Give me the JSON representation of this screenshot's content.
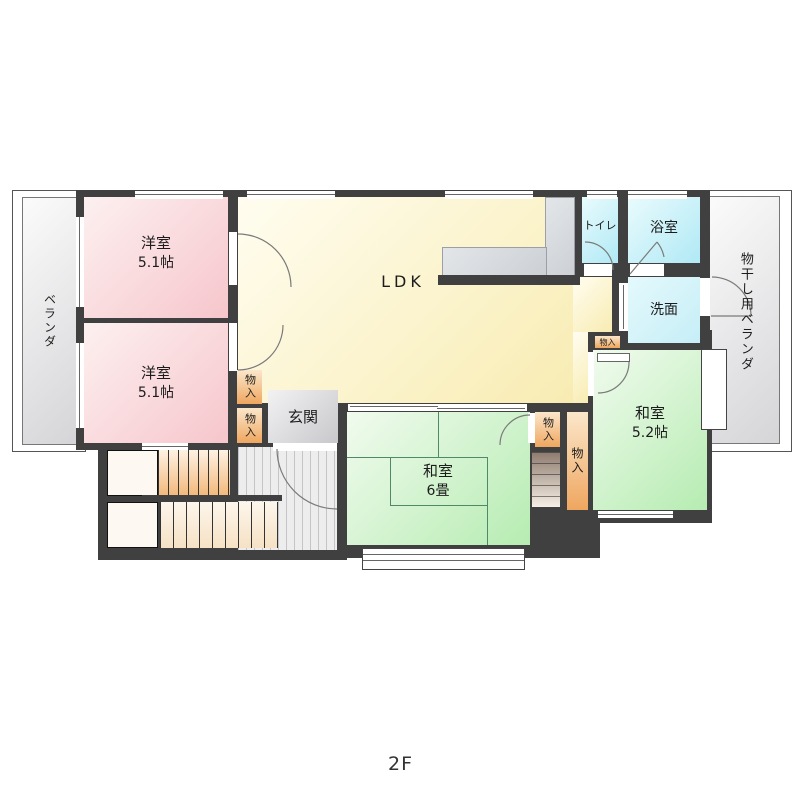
{
  "floor_label": "2F",
  "rooms": {
    "veranda_left": {
      "label": "ベランダ"
    },
    "veranda_right": {
      "label": "物干し用ベランダ"
    },
    "western_top": {
      "name": "洋室",
      "size": "5.1帖"
    },
    "western_bottom": {
      "name": "洋室",
      "size": "5.1帖"
    },
    "ldk": {
      "label": "LDK"
    },
    "toilet": {
      "label": "トイレ"
    },
    "bath": {
      "label": "浴室"
    },
    "washroom": {
      "label": "洗面"
    },
    "washitsu_6": {
      "name": "和室",
      "size": "6畳"
    },
    "washitsu_52": {
      "name": "和室",
      "size": "5.2帖"
    },
    "genkan": {
      "label": "玄関"
    },
    "storage": {
      "label": "物入"
    },
    "storage_mini": {
      "label": "物入"
    }
  },
  "colors": {
    "wall": "#404040",
    "western_room": "#f6c6cc",
    "ldk": "#f8ecb2",
    "bath": "#b0e9f5",
    "washroom": "#c6eef7",
    "tatami_room": "#b6ecb2",
    "storage": "#efa65f",
    "genkan": "#d9d9dc",
    "veranda": "#d5d5d8",
    "counter": "#ccd0d4"
  }
}
